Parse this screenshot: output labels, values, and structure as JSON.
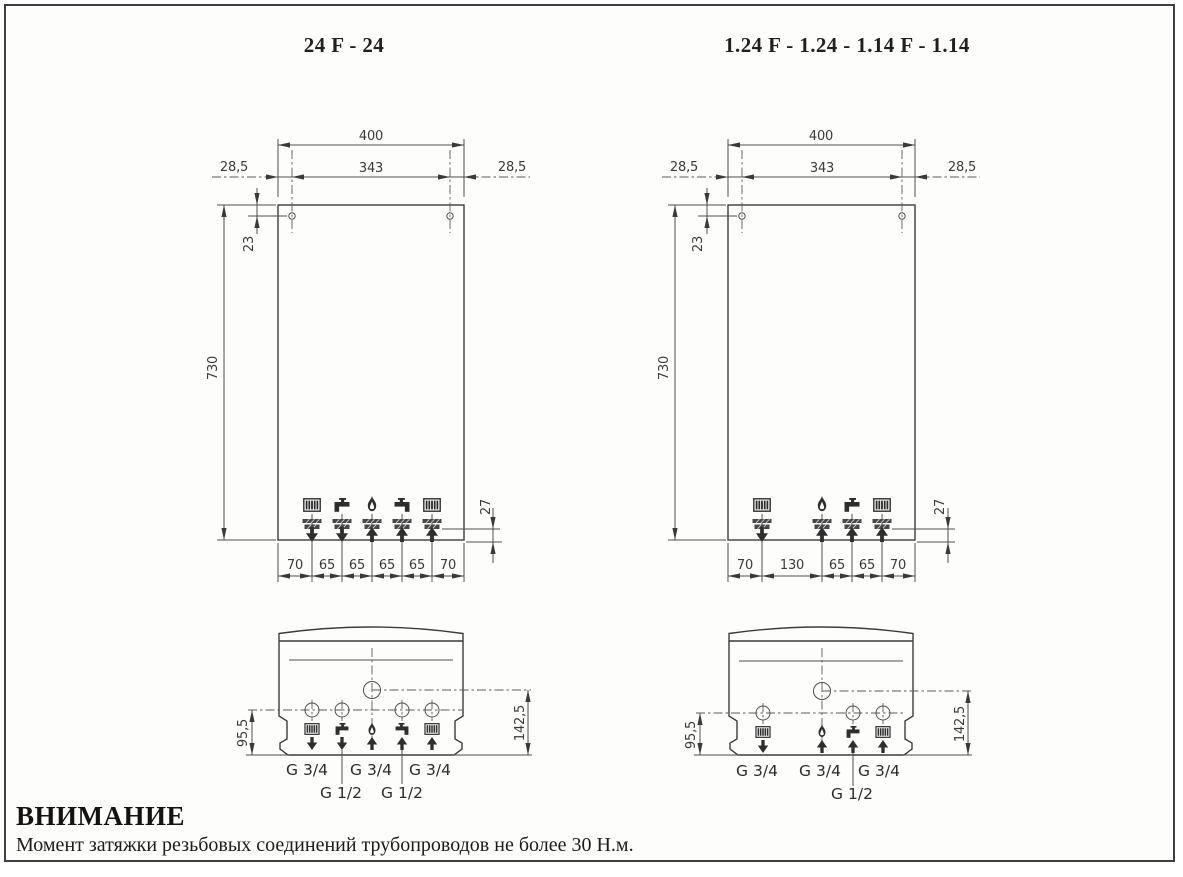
{
  "titles": {
    "left": "24 F - 24",
    "right": "1.24 F - 1.24 - 1.14 F - 1.14"
  },
  "warning": {
    "heading": "ВНИМАНИЕ",
    "body": "Момент затяжки резьбовых соединений трубопроводов не более 30 Н.м."
  },
  "colors": {
    "line": "#4f4f4f",
    "ink": "#2e2e2e",
    "paper": "#fdfdfc"
  },
  "left_figure": {
    "front": {
      "width": "400",
      "hole_span": "343",
      "offset_left": "28,5",
      "offset_right": "28,5",
      "hole_offset": "23",
      "height": "730",
      "connection_offset": "27",
      "spacing": [
        "70",
        "65",
        "65",
        "65",
        "65",
        "70"
      ],
      "connection_icons": [
        "radiator",
        "tap",
        "flame",
        "tap",
        "radiator"
      ],
      "flow_directions": [
        "down",
        "down",
        "up",
        "up",
        "up"
      ]
    },
    "bottom": {
      "connections_depth": "95,5",
      "gas_depth": "142,5",
      "threads_34": [
        "G 3/4",
        "G 3/4",
        "G 3/4"
      ],
      "threads_12": [
        "G 1/2",
        "G 1/2"
      ]
    }
  },
  "right_figure": {
    "front": {
      "width": "400",
      "hole_span": "343",
      "offset_left": "28,5",
      "offset_right": "28,5",
      "hole_offset": "23",
      "height": "730",
      "connection_offset": "27",
      "spacing": [
        "70",
        "130",
        "65",
        "65",
        "70"
      ],
      "connection_icons": [
        "radiator",
        "flame",
        "tap",
        "radiator"
      ],
      "flow_directions": [
        "down",
        "up",
        "up",
        "up"
      ]
    },
    "bottom": {
      "connections_depth": "95,5",
      "gas_depth": "142,5",
      "threads_34": [
        "G 3/4",
        "G 3/4",
        "G 3/4"
      ],
      "threads_12": [
        "G 1/2"
      ]
    }
  }
}
